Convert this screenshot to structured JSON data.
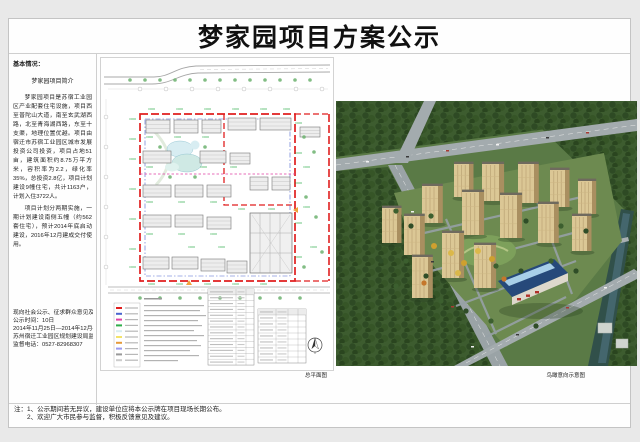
{
  "page": {
    "title": "梦家园项目方案公示"
  },
  "left_panel": {
    "section_heading": "基本情况：",
    "intro_heading": "梦家园项目简介",
    "paragraph1": "梦家园项目是苏宿工业园区产业配套住宅设施，项目西至普陀山大道，南至玄武湖西路，北至青海湖西路，东至十支渠，地理位置优越。项目由宿迁市苏宿工业园区城市发展投资公司投资，项目占地51亩，建筑面积约8.75万平方米，容积率为2.2，绿化率35%，总投资2.8亿，项目计划建设9幢住宅，共计1163户，计划入住3722人。",
    "paragraph2": "项目计划分两期实施，一期计划建设南侧五幢（约562套住宅），预计2014年底启动建设，2016年12月建成交付使用。",
    "notice": [
      "现向社会公示、征求群众意见及建议",
      "公示时间：10日",
      "2014年11月25日—2014年12月4日",
      "苏州宿迁工业园区规划建设局监制",
      "监督电话：0527-82968307"
    ]
  },
  "site_plan": {
    "caption": "总平面图"
  },
  "rendering": {
    "caption": "鸟瞰意向示意图"
  },
  "footnotes": [
    "注：1、公示期间若无异议，建设单位应将本公示牌在项目现场长期公布。",
    "2、欢迎广大市民参与监督，积极反馈意见及建议。"
  ],
  "colors": {
    "boundary_red": "#e01f1f",
    "setback_blue": "#4a63cf",
    "phase_line_magenta": "#e03fa4",
    "annotation_green": "#2fae4a",
    "building_tan": "#dbc795",
    "river_teal": "#31504a",
    "forest_green": "#3d5c2f",
    "commercial_roof_blue": "#26497a"
  }
}
